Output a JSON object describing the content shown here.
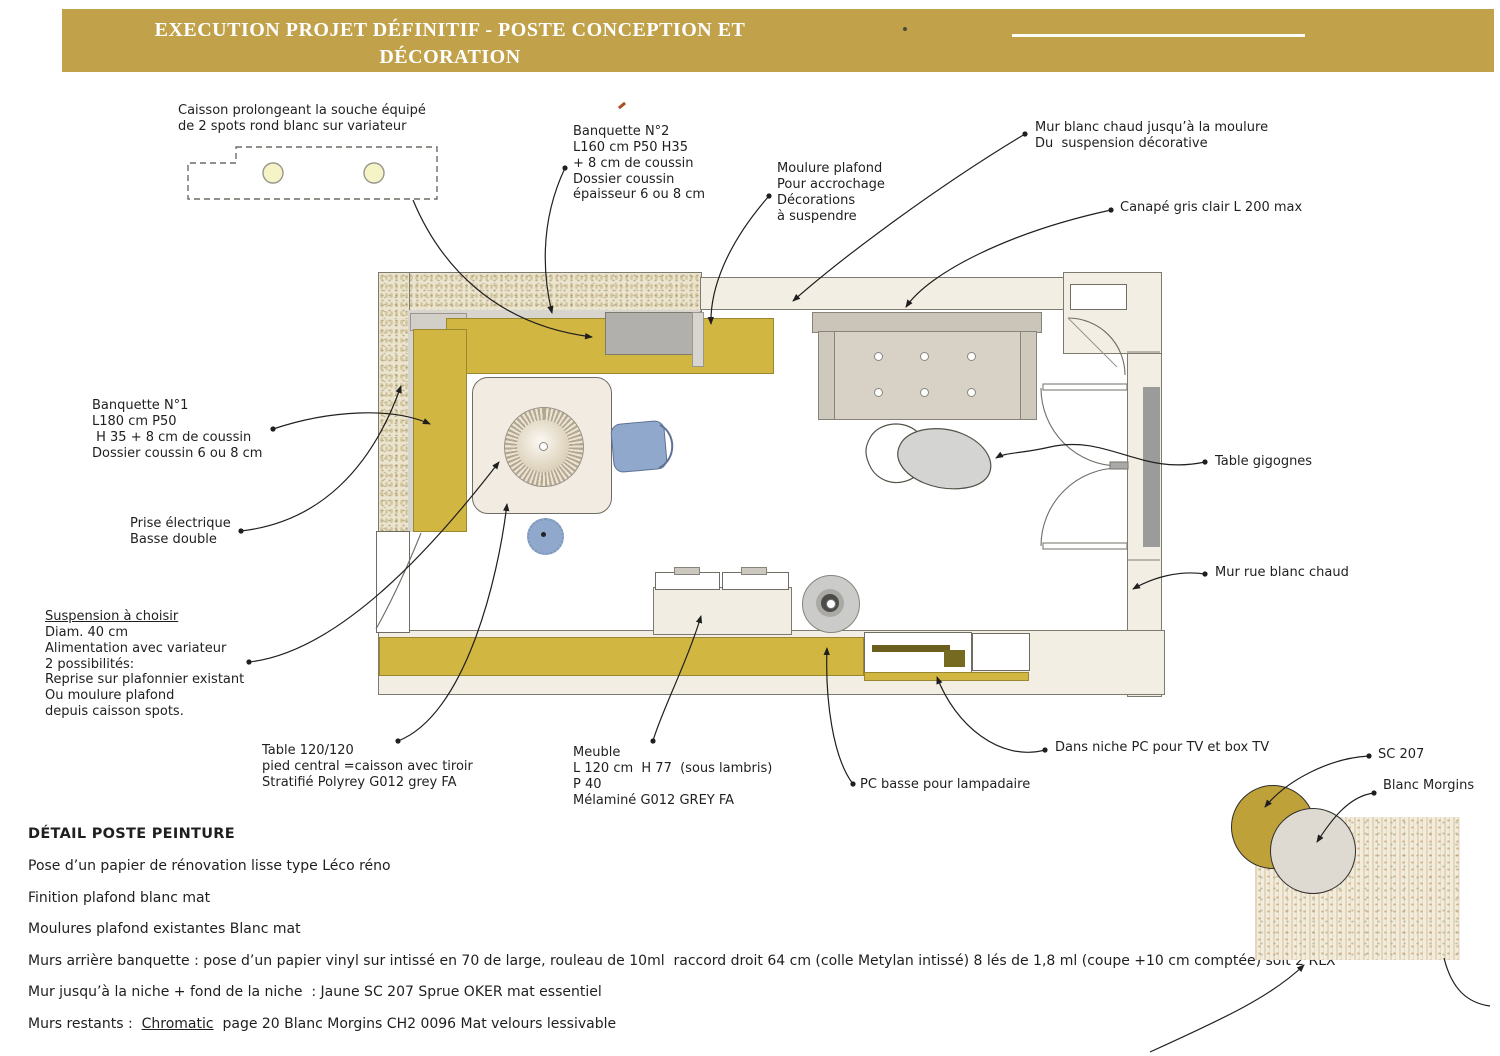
{
  "header": {
    "title_line1": "EXECUTION PROJET DÉFINITIF - POSTE CONCEPTION ET",
    "title_line2": "DÉCORATION"
  },
  "colors": {
    "gold_header": "#c1a24b",
    "banquette_yellow": "#d2b642",
    "chair_blue": "#8fa8cb",
    "gold_swatch": "#bfa13a",
    "tv_olive": "#6a5f1e"
  },
  "annotations": [
    {
      "id": "caisson",
      "x": 178,
      "y": 103,
      "lines": [
        "Caisson prolongeant la souche équipé",
        "de 2 spots rond blanc sur variateur"
      ]
    },
    {
      "id": "banquette-2",
      "x": 573,
      "y": 124,
      "lines": [
        "Banquette N°2",
        "L160 cm P50 H35",
        "+ 8 cm de coussin",
        "Dossier coussin",
        "épaisseur 6 ou 8 cm"
      ]
    },
    {
      "id": "moulure-plafond",
      "x": 777,
      "y": 161,
      "lines": [
        "Moulure plafond",
        "Pour accrochage",
        "Décorations",
        "à suspendre"
      ]
    },
    {
      "id": "mur-blanc-chaud",
      "x": 1035,
      "y": 120,
      "lines": [
        "Mur blanc chaud jusqu’à la moulure",
        "Du  suspension décorative"
      ]
    },
    {
      "id": "canape",
      "x": 1120,
      "y": 200,
      "lines": [
        "Canapé gris clair L 200 max"
      ]
    },
    {
      "id": "banquette-1",
      "x": 92,
      "y": 398,
      "lines": [
        "Banquette N°1",
        "L180 cm P50",
        " H 35 + 8 cm de coussin",
        "Dossier coussin 6 ou 8 cm"
      ]
    },
    {
      "id": "prise-electrique",
      "x": 130,
      "y": 516,
      "lines": [
        "Prise électrique",
        "Basse double"
      ]
    },
    {
      "id": "suspension",
      "x": 45,
      "y": 609,
      "underline_first": true,
      "lines": [
        "Suspension à choisir",
        "Diam. 40 cm",
        "Alimentation avec variateur",
        "2 possibilités:",
        "Reprise sur plafonnier existant",
        "Ou moulure plafond",
        "depuis caisson spots."
      ]
    },
    {
      "id": "table-120",
      "x": 262,
      "y": 743,
      "lines": [
        "Table 120/120",
        "pied central =caisson avec tiroir",
        "Stratifié Polyrey G012 grey FA"
      ]
    },
    {
      "id": "meuble",
      "x": 573,
      "y": 745,
      "lines": [
        "Meuble",
        "L 120 cm  H 77  (sous lambris)",
        "P 40",
        "Mélaminé G012 GREY FA"
      ]
    },
    {
      "id": "pc-basse",
      "x": 860,
      "y": 777,
      "lines": [
        "PC basse pour lampadaire"
      ]
    },
    {
      "id": "niche-pc",
      "x": 1055,
      "y": 740,
      "lines": [
        "Dans niche PC pour TV et box TV"
      ]
    },
    {
      "id": "table-gigognes",
      "x": 1215,
      "y": 454,
      "lines": [
        "Table gigognes"
      ]
    },
    {
      "id": "mur-rue",
      "x": 1215,
      "y": 565,
      "lines": [
        "Mur rue blanc chaud"
      ]
    },
    {
      "id": "sc-207",
      "x": 1378,
      "y": 747,
      "lines": [
        "SC 207"
      ]
    },
    {
      "id": "blanc-morgins",
      "x": 1383,
      "y": 778,
      "lines": [
        "Blanc Morgins"
      ]
    }
  ],
  "paint": {
    "heading": "DÉTAIL POSTE PEINTURE",
    "lines": [
      [
        {
          "t": "Pose d’un papier de rénovation lisse type Léco réno"
        }
      ],
      [
        {
          "t": "Finition plafond blanc mat"
        }
      ],
      [
        {
          "t": "Moulures plafond existantes Blanc mat"
        }
      ],
      [
        {
          "t": "Murs arrière banquette : pose d’un papier vinyl sur intissé en 70 de large, rouleau de 10ml  raccord droit 64 cm (colle Metylan intissé) 8 lés de 1,8 ml (coupe +10 cm comptée) soit 2 RLX"
        }
      ],
      [
        {
          "t": "Mur jusqu’à la niche + fond de la niche  : Jaune SC 207 Sprue OKER mat essentiel"
        }
      ],
      [
        {
          "t": "Murs restants :  "
        },
        {
          "t": "Chromatic",
          "u": true
        },
        {
          "t": "  page 20 Blanc Morgins CH2 0096 Mat velours lessivable"
        }
      ]
    ]
  }
}
